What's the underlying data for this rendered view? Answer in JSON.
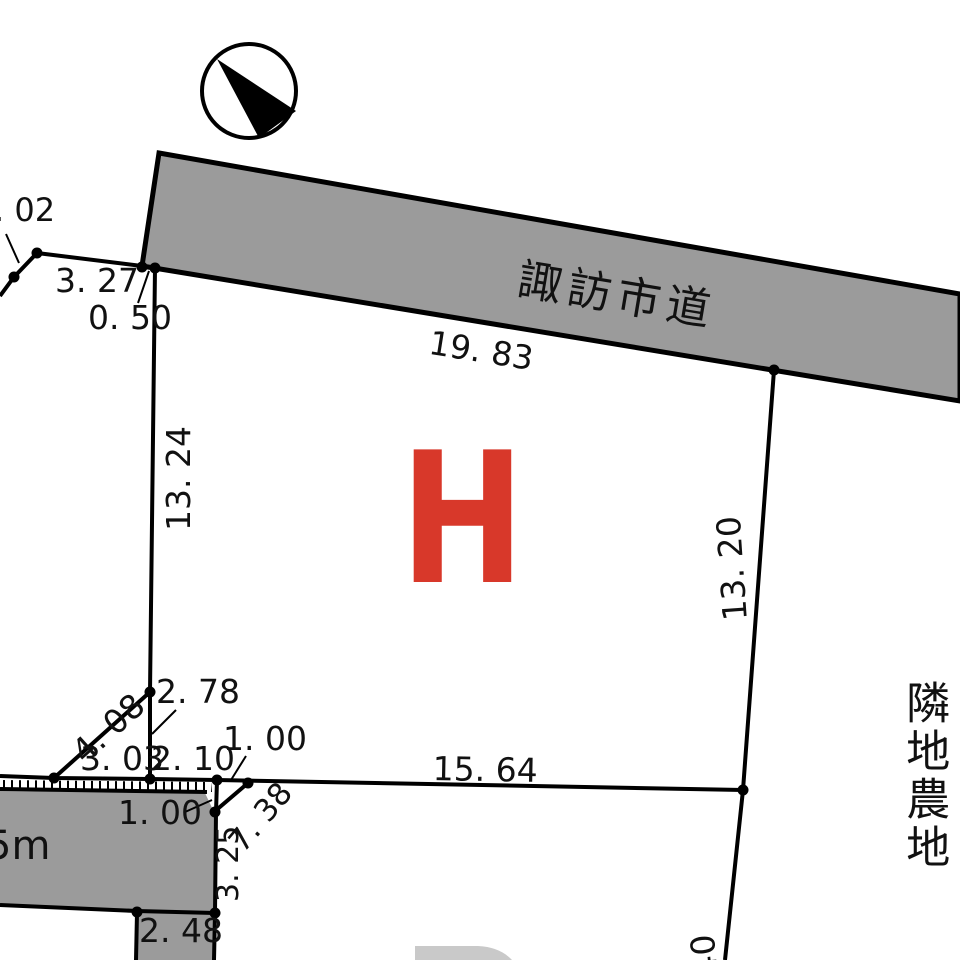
{
  "drawing": {
    "type": "cadastral-survey-plan",
    "road": {
      "name": "諏訪市道"
    },
    "neighbor_label": "隣地農地",
    "parcel": {
      "letter": "H",
      "color": "#d8382a"
    },
    "lower_road_label": "5m",
    "compass": {
      "icon": "north-arrow-icon"
    },
    "dims": {
      "partial_02": ". 02",
      "d3_27": "3. 27",
      "d0_50": "0. 50",
      "d19_83": "19. 83",
      "d13_24": "13. 24",
      "d13_20": "13. 20",
      "d2_78": "2. 78",
      "d4_08": "4. 08",
      "d3_03": "3. 03",
      "d2_10": "2. 10",
      "d1_00_top": "1. 00",
      "d15_64": "15. 64",
      "d1_00_low": "1. 00",
      "d7_38": "7. 38",
      "d3_25": "3. 25",
      "d2_48": "2. 48",
      "d40_partial": "40"
    },
    "colors": {
      "road_gray": "#9b9b9b",
      "light_gray": "#c9c9c9",
      "parcel_red": "#d8382a",
      "line_black": "#000000"
    }
  }
}
